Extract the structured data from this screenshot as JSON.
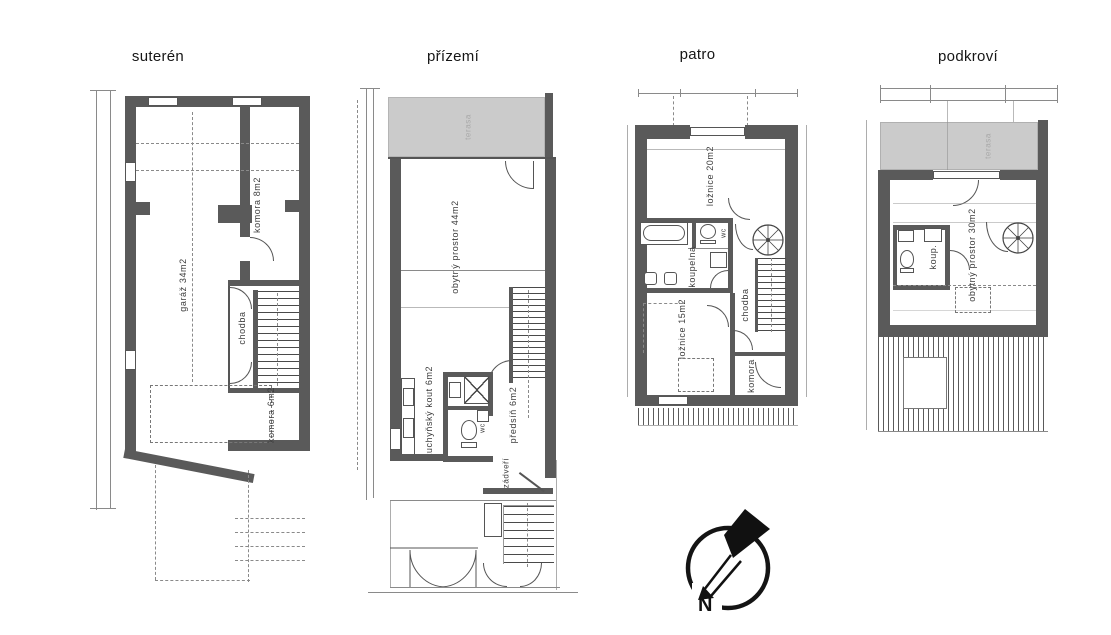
{
  "sheet": {
    "background": "#ffffff"
  },
  "colors": {
    "wall": "#5a5a5a",
    "terrace": "#cbcbcb",
    "line": "#555555"
  },
  "floors": [
    {
      "id": "suteren",
      "title": "suterén",
      "rooms": [
        {
          "label": "garáž 34m2"
        },
        {
          "label": "komora 8m2"
        },
        {
          "label": "chodba"
        },
        {
          "label": "komora 6m2"
        }
      ]
    },
    {
      "id": "prizemi",
      "title": "přízemí",
      "terrace_label": "terasa",
      "rooms": [
        {
          "label": "obytný prostor 44m2"
        },
        {
          "label": "kuchyňský kout 6m2"
        },
        {
          "label": "předsíň 6m2"
        },
        {
          "label": "zádveří"
        },
        {
          "label": "wc"
        }
      ]
    },
    {
      "id": "patro",
      "title": "patro",
      "rooms": [
        {
          "label": "ložnice 20m2"
        },
        {
          "label": "koupelna"
        },
        {
          "label": "wc"
        },
        {
          "label": "ložnice 15m2"
        },
        {
          "label": "chodba"
        },
        {
          "label": "komora"
        }
      ]
    },
    {
      "id": "podkrovi",
      "title": "podkroví",
      "terrace_label": "terasa",
      "rooms": [
        {
          "label": "obytný prostor 30m2"
        },
        {
          "label": "koup."
        }
      ]
    }
  ],
  "compass": {
    "north_label": "N"
  }
}
